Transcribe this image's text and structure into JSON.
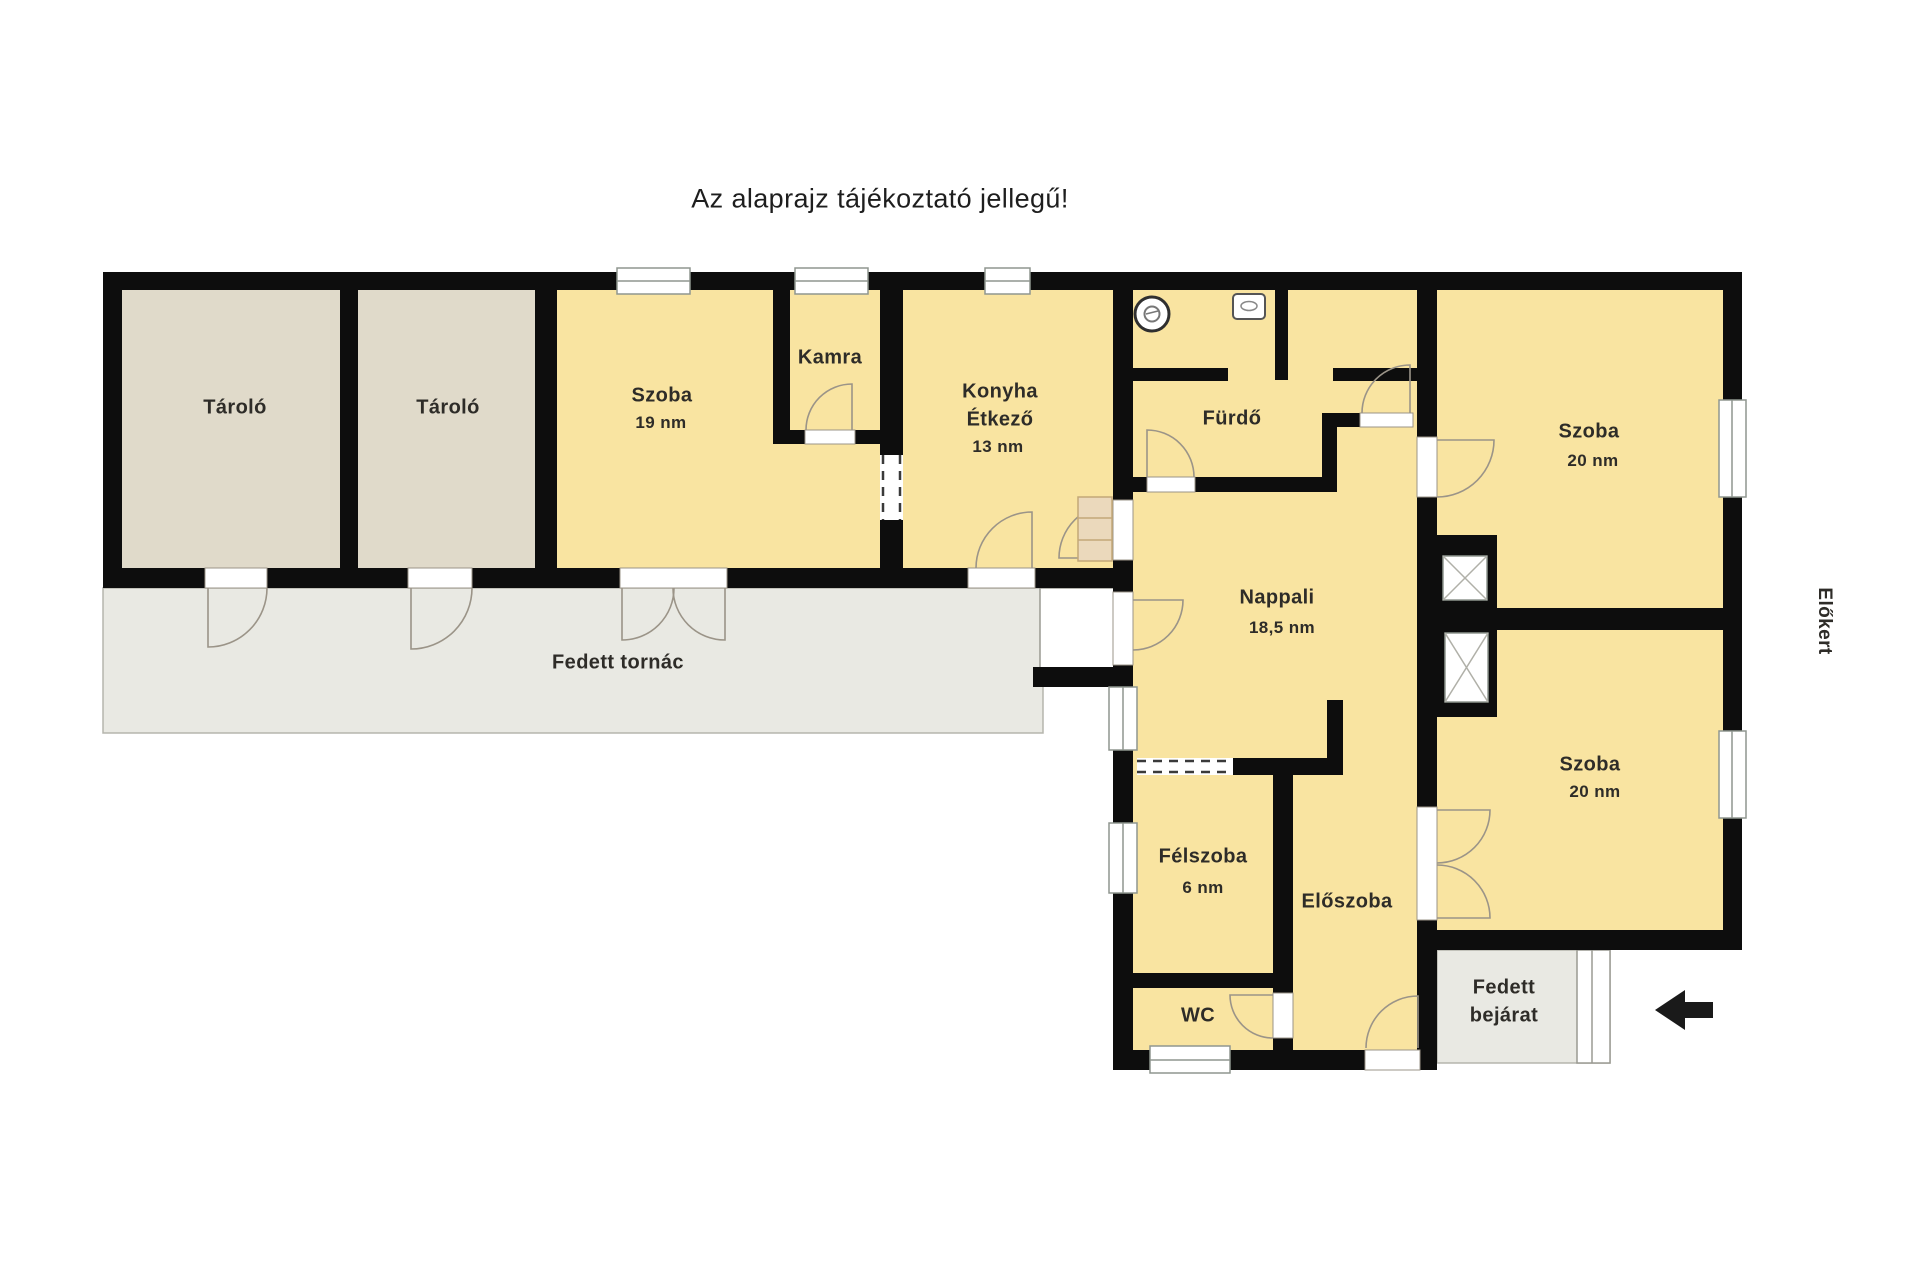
{
  "title": "Az alaprajz tájékoztató jellegű!",
  "colors": {
    "room_fill": "#F9E4A1",
    "storage_fill": "#E0DACA",
    "outdoor_fill": "#E9E9E3",
    "wall": "#0D0D0D",
    "step_fill": "#EBD9BC",
    "door_line": "#9B9488"
  },
  "rooms": {
    "storage_1": {
      "label": "Tároló"
    },
    "storage_2": {
      "label": "Tároló"
    },
    "room_19": {
      "label": "Szoba",
      "area": "19 nm"
    },
    "pantry": {
      "label": "Kamra"
    },
    "kitchen": {
      "label": "Konyha",
      "label2": "Étkező",
      "area": "13 nm"
    },
    "bathroom": {
      "label": "Fürdő"
    },
    "room_20_top": {
      "label": "Szoba",
      "area": "20 nm"
    },
    "living_room": {
      "label": "Nappali",
      "area": "18,5 nm"
    },
    "half_room": {
      "label": "Félszoba",
      "area": "6 nm"
    },
    "hallway": {
      "label": "Előszoba"
    },
    "wc": {
      "label": "WC"
    },
    "room_20_bottom": {
      "label": "Szoba",
      "area": "20 nm"
    },
    "porch": {
      "label": "Fedett tornác"
    },
    "covered_entrance": {
      "label_line1": "Fedett",
      "label_line2": "bejárat"
    },
    "front_garden": {
      "label": "Előkert"
    }
  }
}
